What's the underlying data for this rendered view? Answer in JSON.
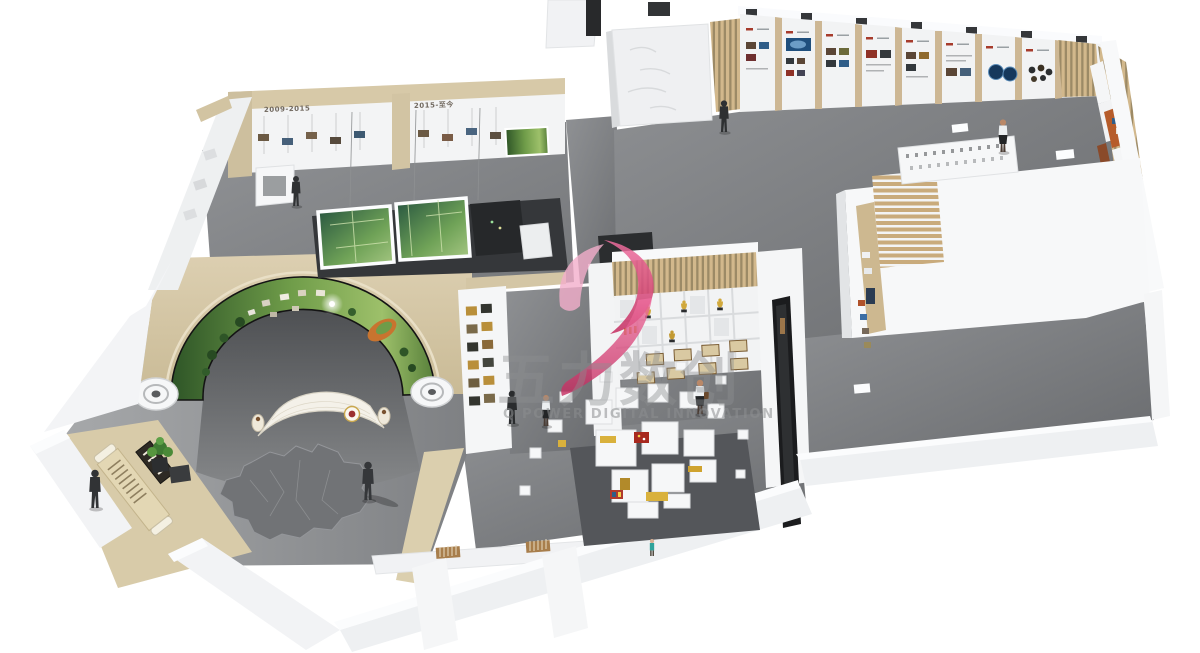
{
  "watermark": {
    "logo_icon": "pink-swoosh-logo",
    "cn_text": "五力数创",
    "en_text": "Q POWER DIGITAL INNOVATION",
    "colors": {
      "pink_light": "#f2aeca",
      "pink_dark": "#c42a5e",
      "text_gray": "#8d8f91"
    }
  },
  "timeline_wall": {
    "era_label_left": "2009-2015",
    "era_label_right": "2015-至今"
  },
  "palette": {
    "background": "#ffffff",
    "wall_white": "#f4f5f6",
    "wall_beige": "#d6c8a6",
    "wood_slat": "#c9ad7e",
    "floor_gray": "#85878a",
    "floor_dark": "#55575a",
    "screen_green": "#5d8f45",
    "trophy_gold": "#cfa93d",
    "media_screen_black": "#1b1c1e",
    "track_orange": "#c8742f"
  }
}
